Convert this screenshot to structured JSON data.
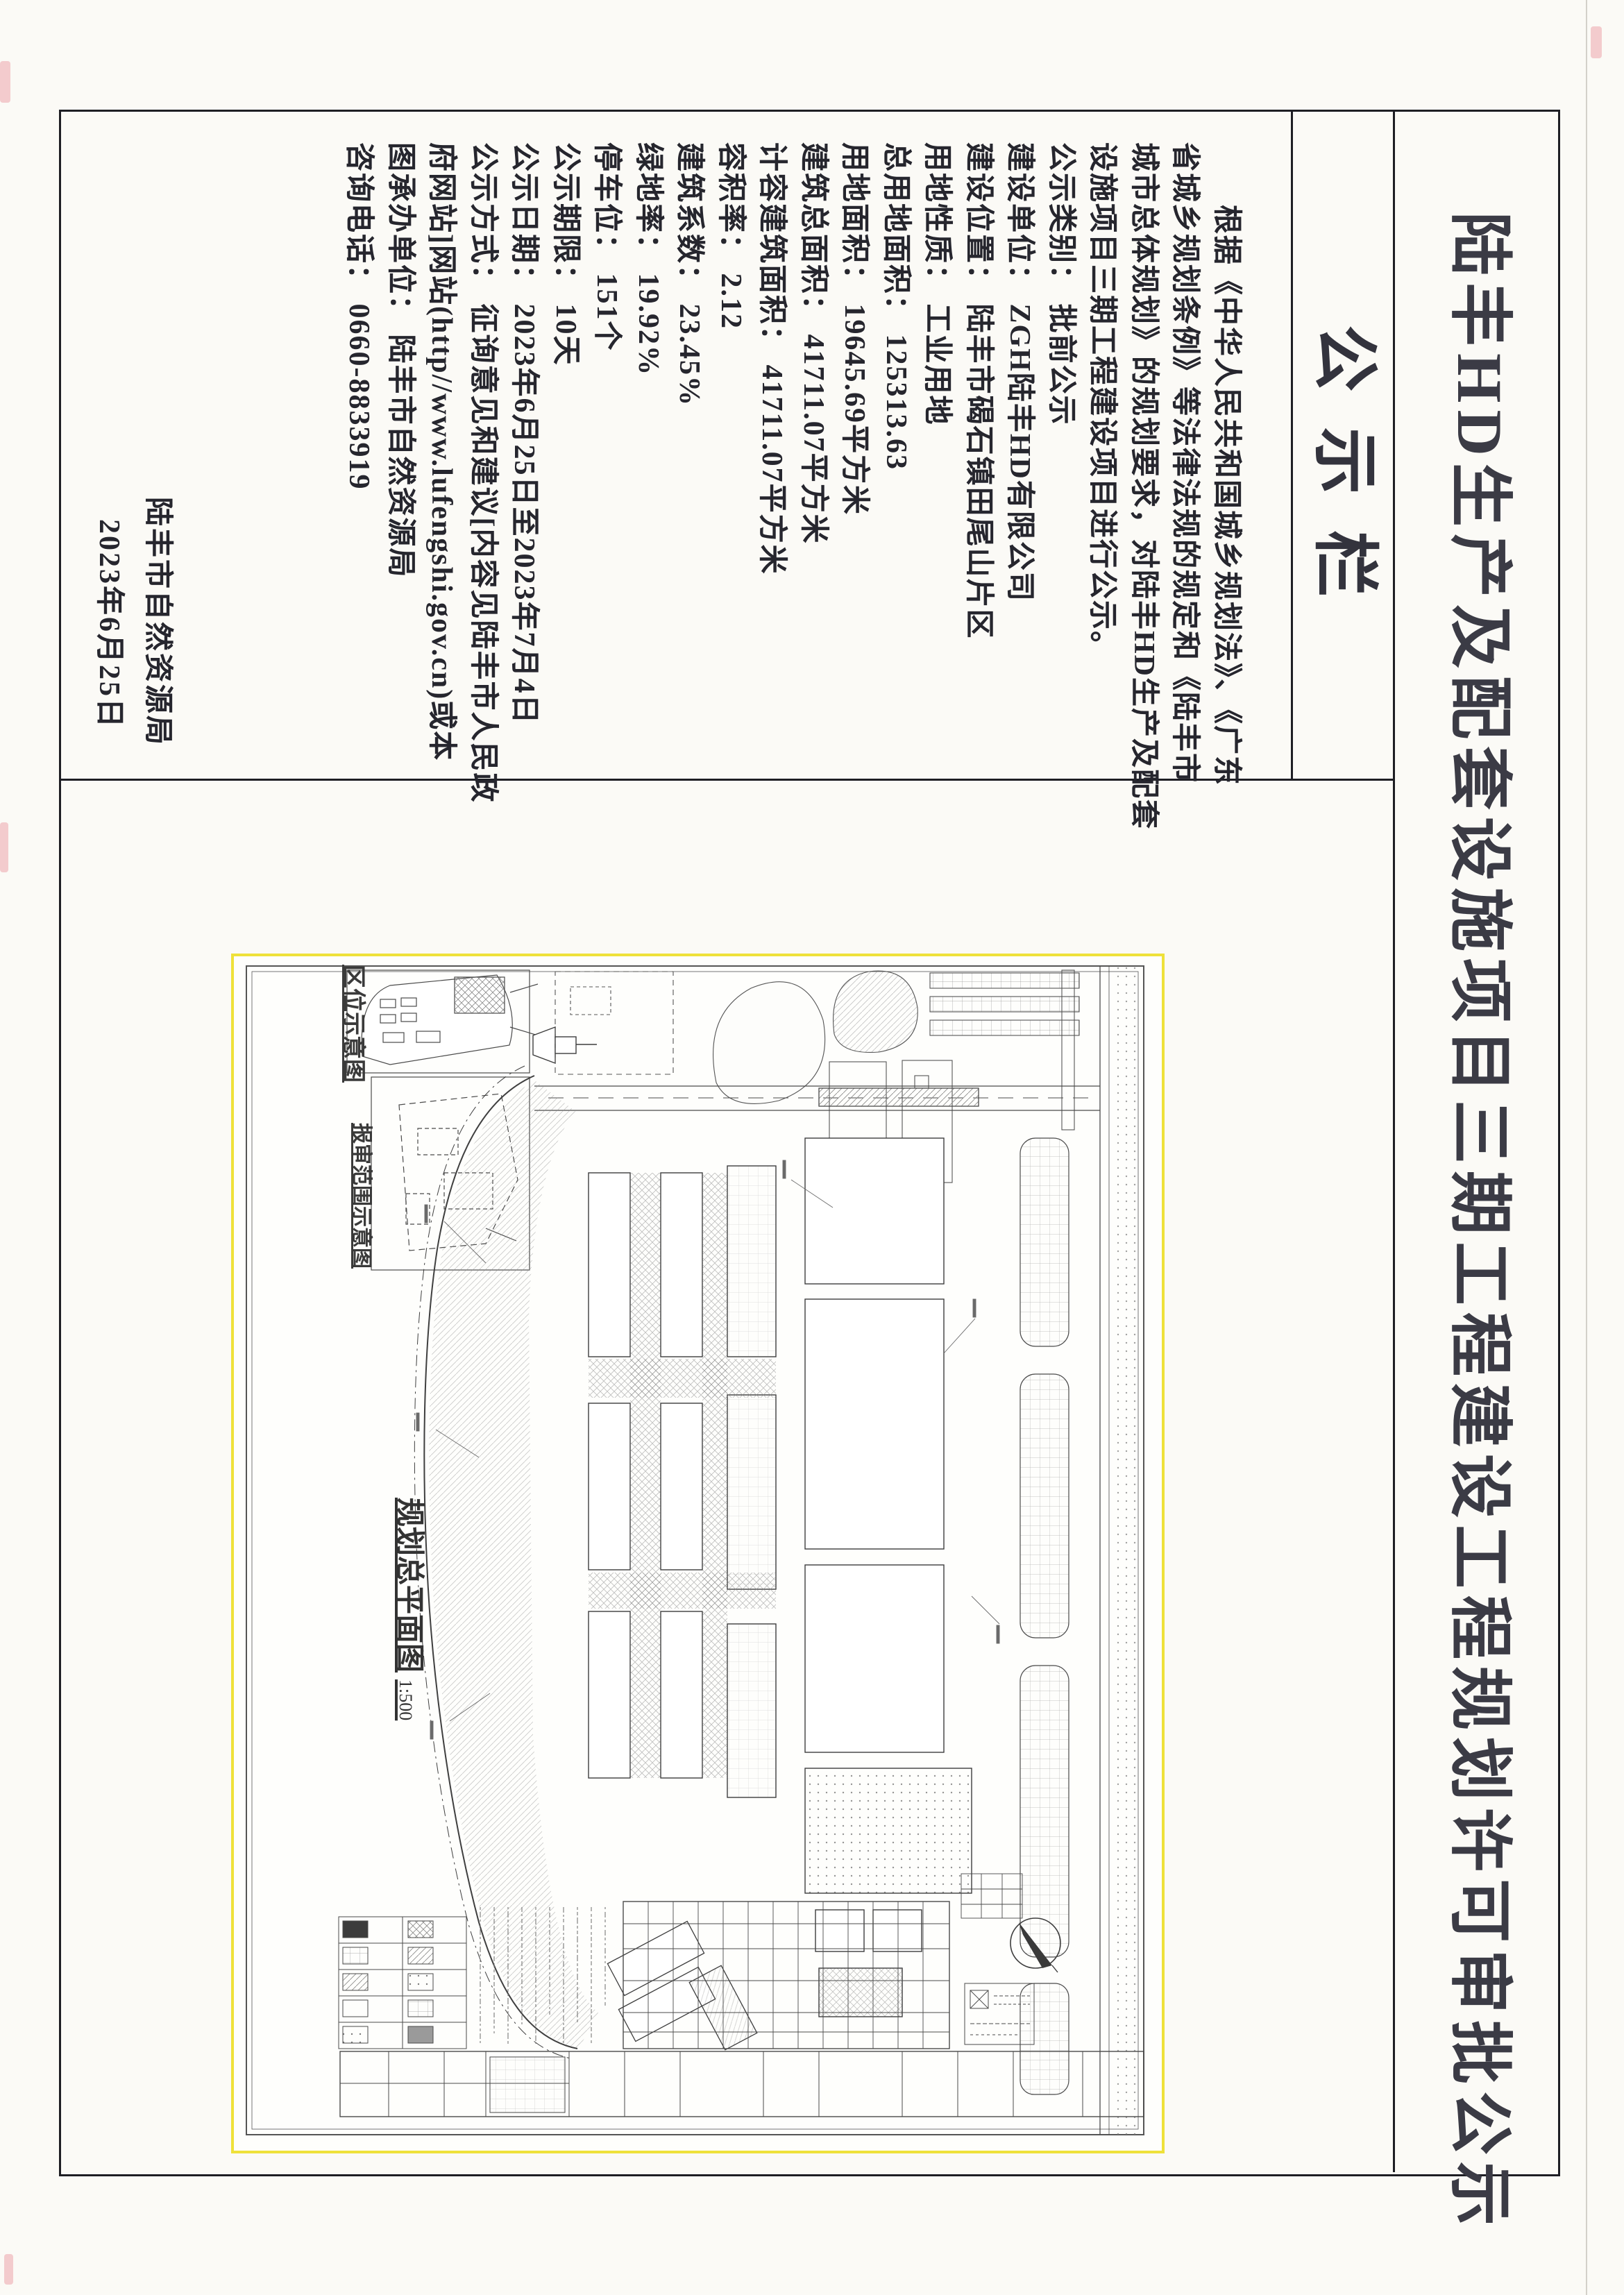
{
  "doc": {
    "title": "陆丰HD生产及配套设施项目三期工程建设工程规划许可审批公示",
    "board_label": "公示栏",
    "columns": [
      "根据《中华人民共和国城乡规划法》、《广东",
      "省城乡规划条例》等法律法规的规定和《陆丰市",
      "城市总体规划》的规划要求，对陆丰HD生产及配套",
      "设施项目三期工程建设项目进行公示。",
      "公示类别： 批前公示",
      "建设单位： ZGH陆丰HD有限公司",
      "建设位置： 陆丰市碣石镇田尾山片区",
      "用地性质： 工业用地",
      "总用地面积： 125313.63",
      "用地面积： 19645.69平方米",
      "建筑总面积： 41711.07平方米",
      "计容建筑面积： 41711.07平方米",
      "容积率： 2.12",
      "建筑系数： 23.45%",
      "绿地率： 19.92%",
      "停车位： 151个",
      "公示期限： 10天",
      "公示日期： 2023年6月25日至2023年7月4日",
      "公示方式： 征询意见和建议[内容见陆丰市人民政",
      "府网站]网站(http//www.lufengshi.gov.cn)或本",
      "图承办单位： 陆丰市自然资源局",
      "咨询电话： 0660-8833919"
    ],
    "fields": [
      {
        "label": "公示类别",
        "value": "批前公示"
      },
      {
        "label": "建设单位",
        "value": "ZGH陆丰HD有限公司"
      },
      {
        "label": "建设位置",
        "value": "陆丰市碣石镇田尾山片区"
      },
      {
        "label": "用地性质",
        "value": "工业用地"
      },
      {
        "label": "总用地面积",
        "value": "125313.63"
      },
      {
        "label": "用地面积",
        "value": "19645.69平方米"
      },
      {
        "label": "建筑总面积",
        "value": "41711.07平方米"
      },
      {
        "label": "计容建筑面积",
        "value": "41711.07平方米"
      },
      {
        "label": "容积率",
        "value": "2.12"
      },
      {
        "label": "建筑系数",
        "value": "23.45%"
      },
      {
        "label": "绿地率",
        "value": "19.92%"
      },
      {
        "label": "停车位",
        "value": "151个"
      },
      {
        "label": "公示期限",
        "value": "10天"
      },
      {
        "label": "公示日期",
        "value": "2023年6月25日至2023年7月4日"
      },
      {
        "label": "公示方式",
        "value": "征询意见和建议[内容见陆丰市人民政府网站]网站(http//www.lufengshi.gov.cn)或本图"
      },
      {
        "label": "承办单位",
        "value": "陆丰市自然资源局"
      },
      {
        "label": "咨询电话",
        "value": "0660-8833919"
      }
    ],
    "signature_agency": "陆丰市自然资源局",
    "signature_date": "2023年6月25日"
  },
  "plan": {
    "inset1_caption": "区位示意图",
    "inset2_caption": "报审范围示意图",
    "main_caption": "规划总平面图",
    "main_scale": "1:500"
  },
  "colors": {
    "ink": "#23232b",
    "frame": "#1e1e24",
    "photo_border_yellow": "#efe13a",
    "paper": "#fbfaf6"
  }
}
